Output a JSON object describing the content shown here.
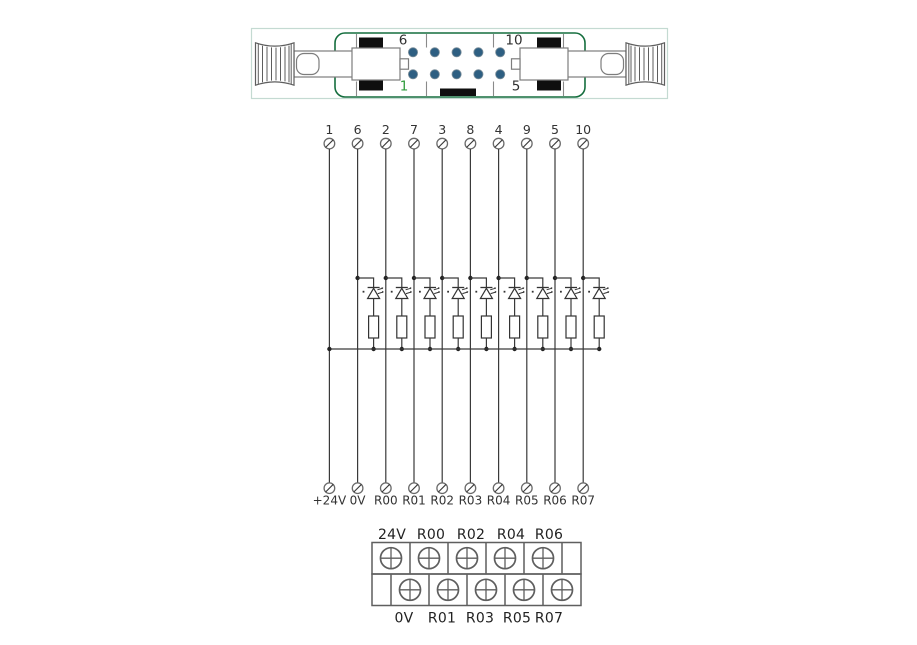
{
  "connector": {
    "corner_pin_labels": {
      "top_left": "6",
      "top_right": "10",
      "bottom_left": "1",
      "bottom_right": "5"
    },
    "pin_rows": 2,
    "pin_cols": 5,
    "colors": {
      "body_outline": "#156e3e",
      "outer_frame": "#c4dad2",
      "pin_dot": "#2e5f82",
      "pin1_label_green": "#2f9b3c",
      "hardware_black": "#0f0f0f"
    }
  },
  "circuit": {
    "top_terminals": [
      "1",
      "6",
      "2",
      "7",
      "3",
      "8",
      "4",
      "9",
      "5",
      "10"
    ],
    "bottom_terminals": [
      "+24V",
      "0V",
      "R00",
      "R01",
      "R02",
      "R03",
      "R04",
      "R05",
      "R06",
      "R07"
    ],
    "led_resistor_branches": 9,
    "wire_color": "#3a3a3a"
  },
  "terminal_block": {
    "top_labels": [
      "24V",
      "R00",
      "R02",
      "R04",
      "R06"
    ],
    "bottom_labels": [
      "0V",
      "R01",
      "R03",
      "R05",
      "R07"
    ]
  }
}
